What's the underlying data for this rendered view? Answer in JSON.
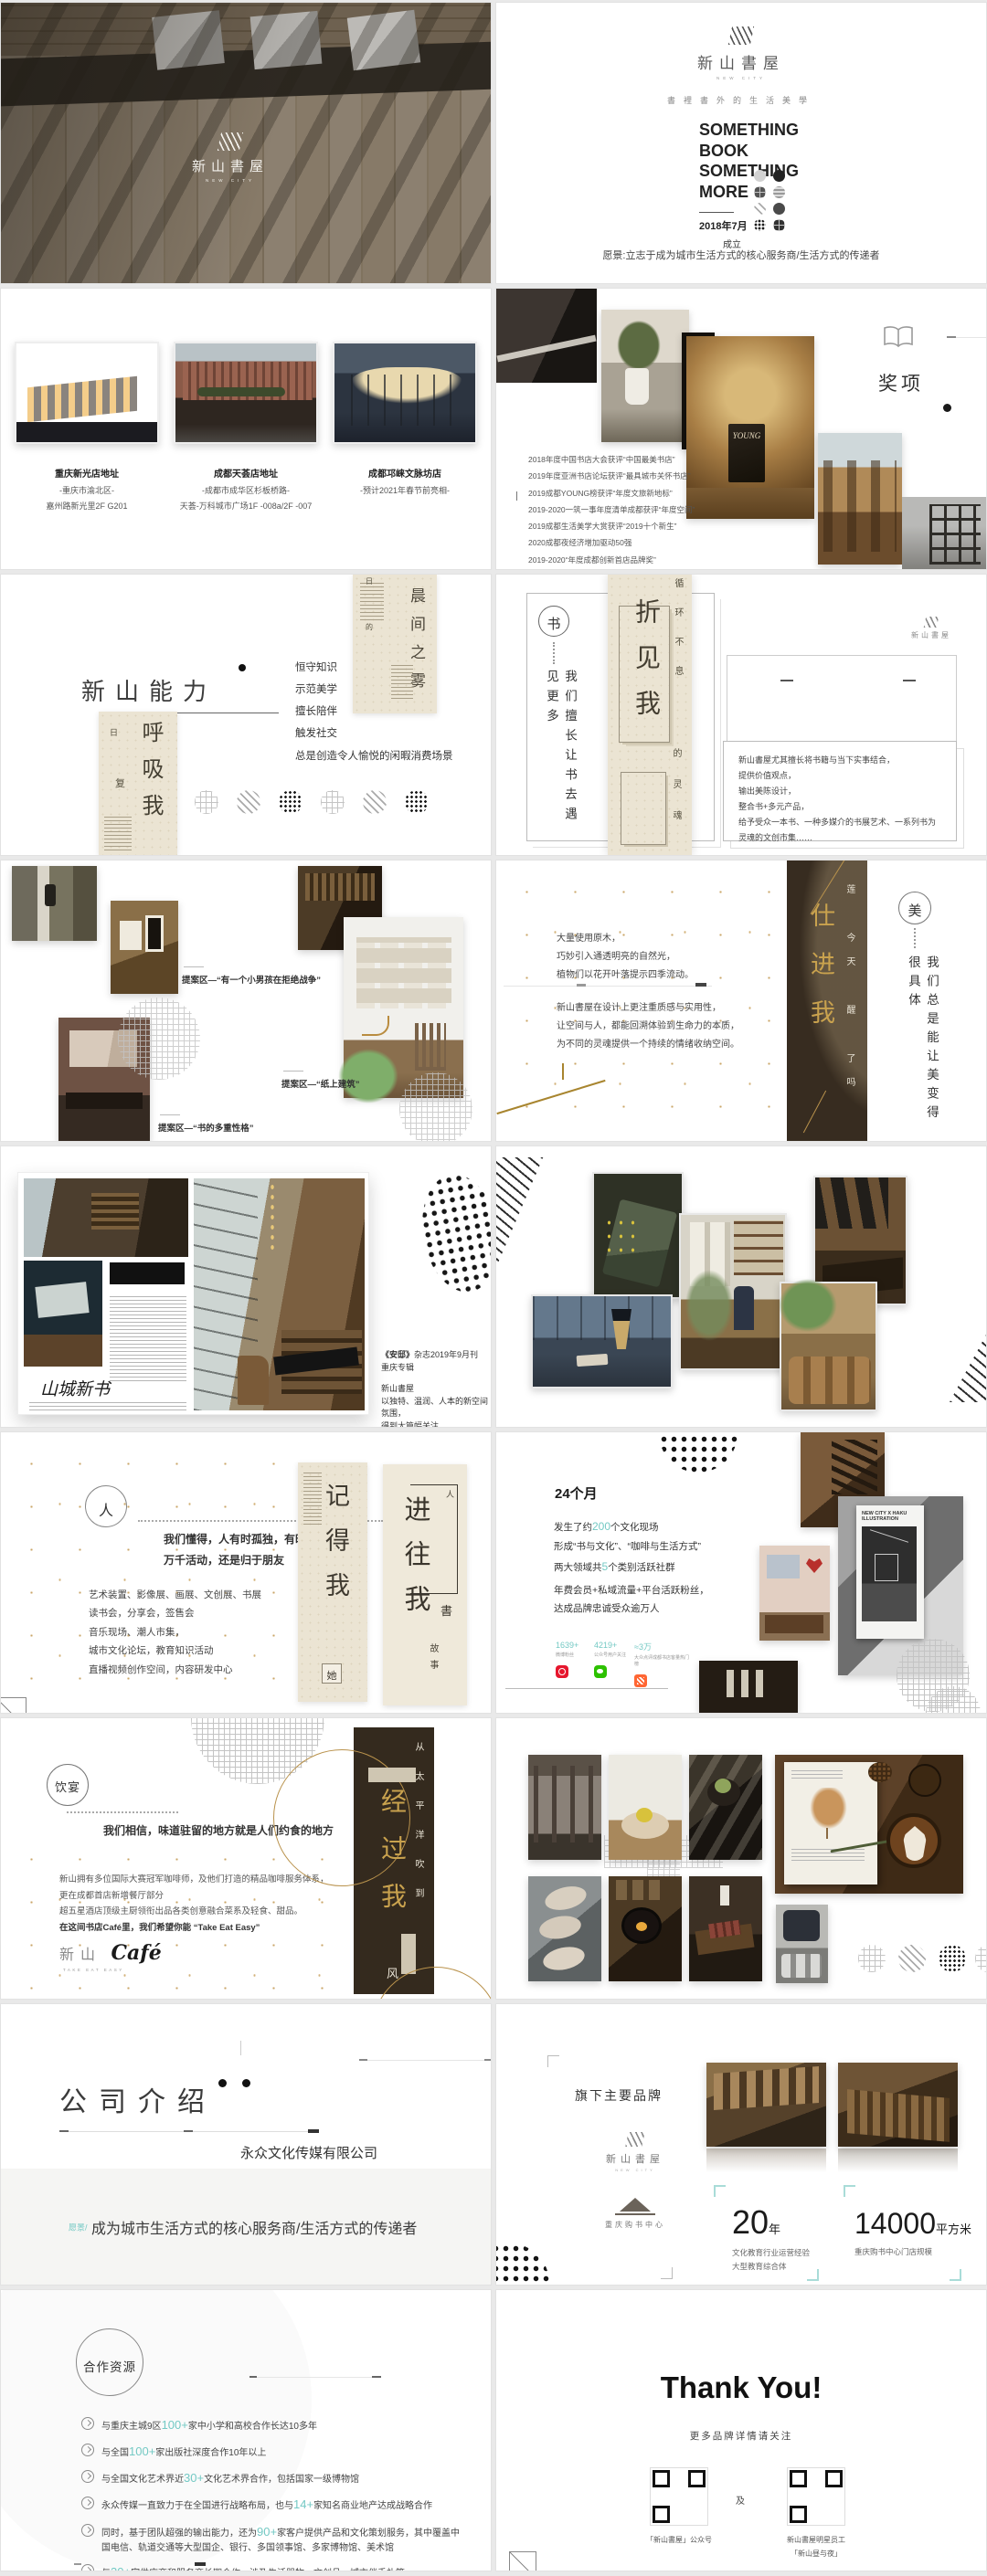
{
  "meta": {
    "accent_teal": "#74c9c4",
    "gold": "#b9924c",
    "poster_dark": "#362b1f",
    "poster_beige": "#ebe4d3"
  },
  "cover": {
    "brand": "新山書屋",
    "brand_sub": "NEW CITY"
  },
  "title": {
    "brand": "新山書屋",
    "brand_sub": "NEW CITY",
    "tagline": "書裡書外的生活美學",
    "lines": [
      "SOMETHING",
      "BOOK",
      "SOMETHING",
      "MORE"
    ],
    "date": "2018年7月",
    "founded": "成立",
    "vision": "愿景:立志于成为城市生活方式的核心服务商/生活方式的传递者"
  },
  "stores": {
    "items": [
      {
        "name": "重庆新光店地址",
        "line1": "-重庆市渝北区-",
        "line2": "嘉州路新光里2F G201"
      },
      {
        "name": "成都天荟店地址",
        "line1": "-成都市成华区杉板桥路-",
        "line2": "天荟-万科城市广场1F -008a/2F -007"
      },
      {
        "name": "成都邛崃文脉坊店",
        "line1": "-预计2021年春节前亮相-",
        "line2": ""
      }
    ]
  },
  "awards": {
    "title": "奖项",
    "poster_word": "YOUNG",
    "banner": "ASIAN BOOK STORE FORUM",
    "list": [
      "2018年度中国书店大会获评“中国最美书店”",
      "2019年度亚洲书店论坛获评“最具城市关怀书店”",
      "2019成都YOUNG榜获评“年度文旅新地标”",
      "2019-2020一筑一事年度清单成都获评“年度空间”",
      "2019成都生活美学大赏获评“2019十个新生”",
      "2020成都夜经济增加驱动50强",
      "2019-2020“年度成都创新首店品牌奖”"
    ]
  },
  "ability": {
    "heading": "新山能力",
    "items": [
      "恒守知识",
      "示范美学",
      "擅长陪伴",
      "触发社交",
      "总是创造令人愉悦的闲暇消费场景"
    ],
    "poster_top": {
      "big": "晨间之雾",
      "side1": "日",
      "side2": "的"
    },
    "poster_left": {
      "big": "呼吸我",
      "side1": "日",
      "side2": "复"
    }
  },
  "books": {
    "badge": "书",
    "vertical": "我们擅长让书去遇见更多",
    "poster_big": "折见我",
    "poster_side": "循环不息",
    "poster_side2": "的灵魂",
    "brand": "新山書屋",
    "lines": [
      "新山書屋尤其擅长将书籍与当下实事结合，",
      "提供价值观点，",
      "输出美陈设计，",
      "整合书+多元产品，",
      "给予受众一本书、一种多媒介的书展艺术、一系列书为灵魂的文创市集……"
    ]
  },
  "proposals": {
    "captions": [
      "提案区—“有一个小男孩在拒绝战争”",
      "提案区—“书的多重性格”",
      "提案区—“纸上建筑”"
    ]
  },
  "beauty": {
    "p1": [
      "大量使用原木，",
      "巧妙引入通透明亮的自然光，",
      "植物们以花开叶落提示四季流动。"
    ],
    "p2": [
      "新山書屋在设计上更注重质感与实用性，",
      "让空间与人，都能回溯体验到生命力的本质，",
      "为不同的灵魂提供一个持续的情绪收纳空间。"
    ],
    "badge": "美",
    "vertical": "我们总是能让美变得很具体",
    "poster_gold": "仕进我",
    "poster_small": "莲 今天 醒 了吗"
  },
  "press": {
    "magazine_title": "山城新书",
    "note_bold": "《安邸》",
    "note1": "杂志2019年9月刊",
    "note2": "重庆专辑",
    "note3": "新山書屋",
    "note4": "以独特、温润、人本的新空间氛围，",
    "note5": "得到大篇幅关注"
  },
  "people": {
    "badge": "人",
    "intro": [
      "我们懂得，人有时孤独，有时热闹",
      "万千活动，还是归于朋友"
    ],
    "list": [
      "艺术装置、影像展、画展、文创展、书展",
      "读书会，分享会，签售会",
      "音乐现场、潮人市集，",
      "城市文化论坛，教育知识活动",
      "直播视频创作空间，内容研发中心"
    ],
    "posterA": {
      "big": "记得我",
      "tag": "她"
    },
    "posterB": {
      "big": "进往我",
      "tag1": "人",
      "tag2": "書",
      "tag3": "故事"
    }
  },
  "months": {
    "heading": "24个月",
    "p1a": "发生了约",
    "p1n": "200",
    "p1b": "个文化现场",
    "p2": "形成“书与文化”、“咖啡与生活方式”",
    "p3a": "两大领域共",
    "p3n": "5",
    "p3b": "个类别活跃社群",
    "p4": "年费会员+私域流量+平台活跃粉丝，",
    "p5": "达成品牌忠诚受众逾万人",
    "stats": [
      {
        "value": "1639+",
        "label": "微博粉丝"
      },
      {
        "value": "4219+",
        "label": "公众号用户关注"
      },
      {
        "value": "≈3万",
        "label": "大众点评成都书店客量热门榜"
      }
    ],
    "poster_line1": "NEW CITY X HAKU",
    "poster_line2": "ILLUSTRATION"
  },
  "dining": {
    "badge": "饮宴",
    "statement": "我们相信，味道驻留的地方就是人们约食的地方",
    "para": [
      "新山拥有多位国际大赛冠军咖啡师，及他们打造的精品咖啡服务体系，",
      "更在成都首店新增餐厅部分",
      "超五星酒店顶级主厨领衔出品各类创意融合菜系及轻食、甜品。",
      "在这间书店Café里，我们希望你能 “Take Eat Easy”"
    ],
    "logo_cn": "新山",
    "logo_en": "Café",
    "logo_sub": "TAKE EAT EASY",
    "poster_big": "经过我",
    "poster_white": "从太平洋吹到",
    "poster_tail": "风"
  },
  "company": {
    "heading": "公司介绍",
    "name": "永众文化传媒有限公司",
    "vision_label": "愿景/",
    "vision": "成为城市生活方式的核心服务商/生活方式的传递者"
  },
  "brands": {
    "title": "旗下主要品牌",
    "brand1": "新山書屋",
    "brand1_sub": "NEW CITY",
    "brand2": "重庆购书中心",
    "stat1_num": "20",
    "stat1_unit": "年",
    "stat1_l1": "文化教育行业运营经验",
    "stat1_l2": "大型教育综合体",
    "stat2_num": "14000",
    "stat2_unit": "平方米",
    "stat2_l1": "重庆购书中心门店规模"
  },
  "partners": {
    "badge": "合作资源",
    "items": [
      {
        "pre": "与重庆主城9区",
        "num": "100+",
        "post": "家中小学和高校合作长达10多年"
      },
      {
        "pre": "与全国",
        "num": "100+",
        "post": "家出版社深度合作10年以上"
      },
      {
        "pre": "与全国文化艺术界近",
        "num": "30+",
        "post": "文化艺术界合作，包括国家一级博物馆"
      },
      {
        "pre": "永众传媒一直致力于在全国进行战略布局，也与",
        "num": "14+",
        "post": "家知名商业地产达成战略合作"
      },
      {
        "pre": "同时，基于团队超强的输出能力，还为",
        "num": "90+",
        "post": "家客户提供产品和文化策划服务，其中覆盖中国电信、轨道交通等大型国企、银行、多国领事馆、多家博物馆、美术馆"
      },
      {
        "pre": "与",
        "num": "30+",
        "post": "家供应商和服务商长期合作，涉及生活器物、文创品、城市伴手礼等"
      }
    ]
  },
  "thanks": {
    "title": "Thank You!",
    "subtitle": "更多品牌详情请关注",
    "qr1_label": "「新山書屋」公众号",
    "sep": "及",
    "qr2_label1": "新山書屋明星员工",
    "qr2_label2": "「新山昼与夜」"
  }
}
